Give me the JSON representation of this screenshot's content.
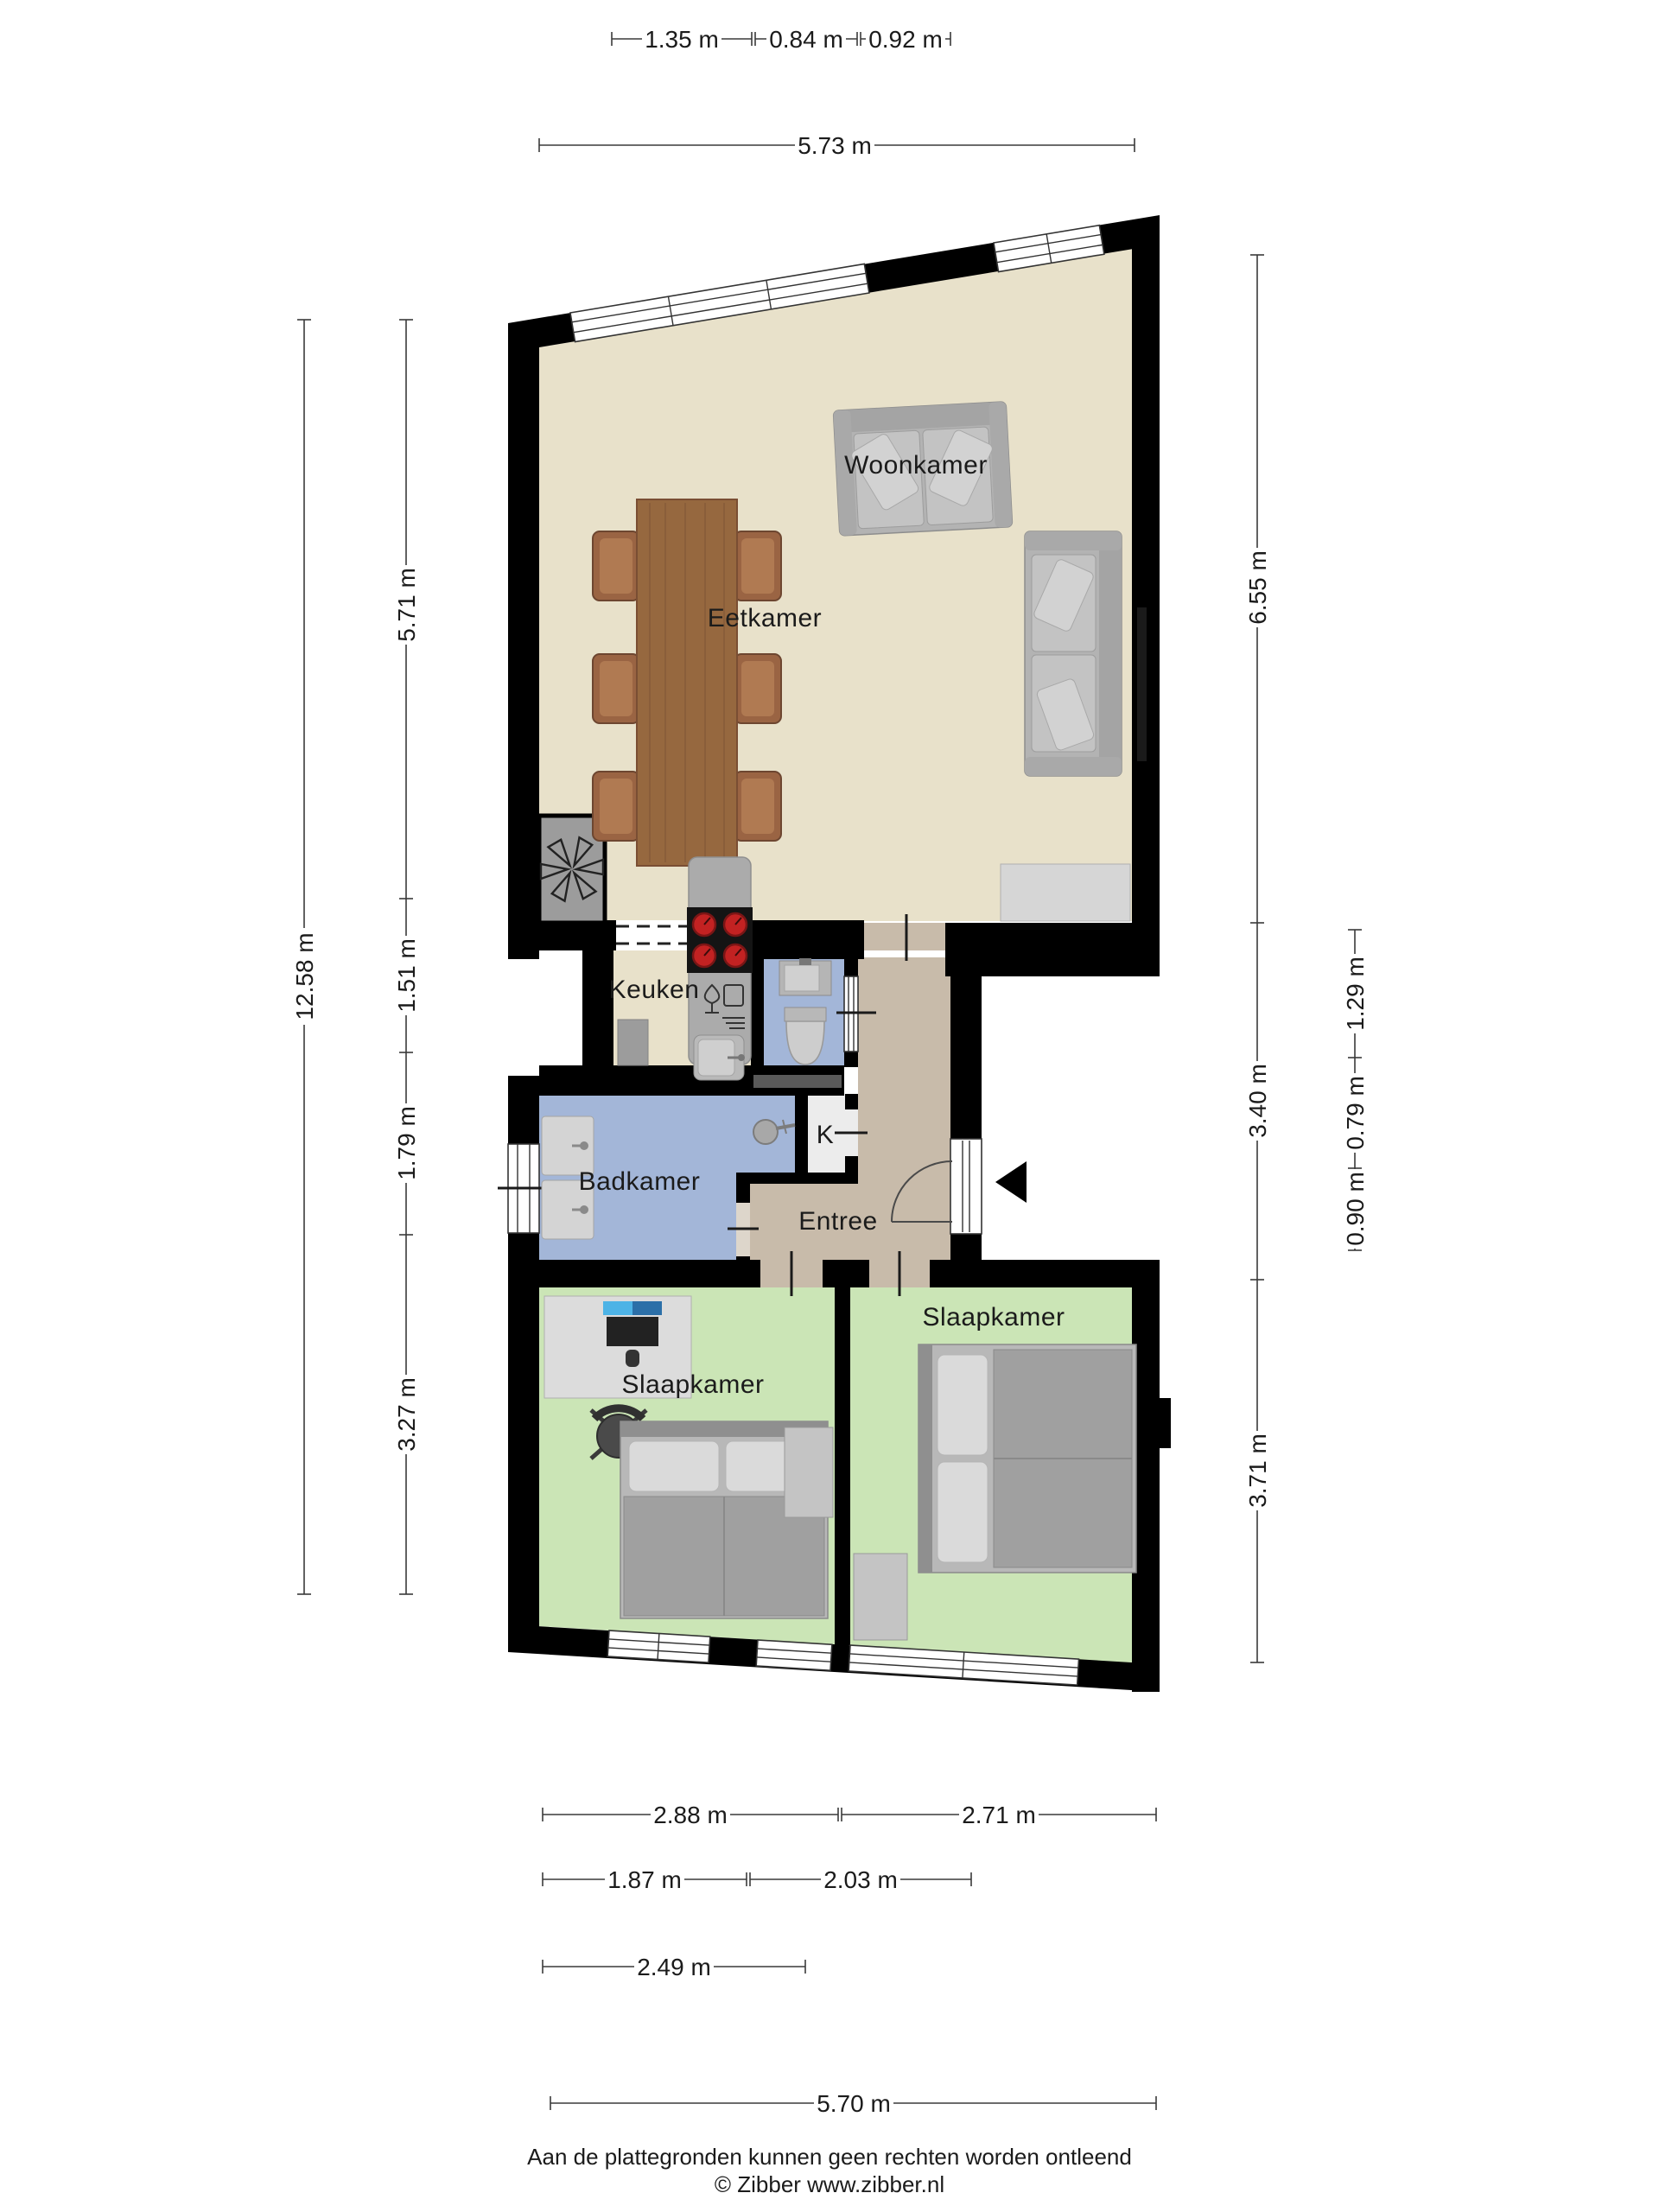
{
  "rooms": {
    "living": "Woonkamer",
    "dining": "Eetkamer",
    "kitchen": "Keuken",
    "bathroom": "Badkamer",
    "closet": "K",
    "hall": "Entree",
    "bedroom_left": "Slaapkamer",
    "bedroom_right": "Slaapkamer"
  },
  "dims": {
    "top": [
      "1.35 m",
      "0.84 m",
      "0.92 m"
    ],
    "top_total": "5.73 m",
    "left_total": "12.58 m",
    "left": [
      "5.71 m",
      "1.51 m",
      "1.79 m",
      "3.27 m"
    ],
    "right": [
      "6.55 m",
      "3.40 m",
      "3.71 m"
    ],
    "right_inner": [
      "1.29 m",
      "0.79 m",
      "0.90 m"
    ],
    "bottom_r1": [
      "2.88 m",
      "2.71 m"
    ],
    "bottom_r2": [
      "1.87 m",
      "2.03 m"
    ],
    "bottom_r3": "2.49 m",
    "bottom_r4": "5.70 m"
  },
  "footer": {
    "disclaimer": "Aan de plattegronden kunnen geen rechten worden ontleend",
    "copyright": "© Zibber www.zibber.nl"
  },
  "colors": {
    "wall": "#000000",
    "floor_living": "#e8e1ca",
    "floor_hall": "#c8bbaa",
    "floor_bath": "#a3b6d8",
    "floor_bedroom": "#cbe5b6",
    "floor_closet": "#ececec",
    "burner_red": "#c22222",
    "laptop_screen": "#3f9fd6"
  }
}
